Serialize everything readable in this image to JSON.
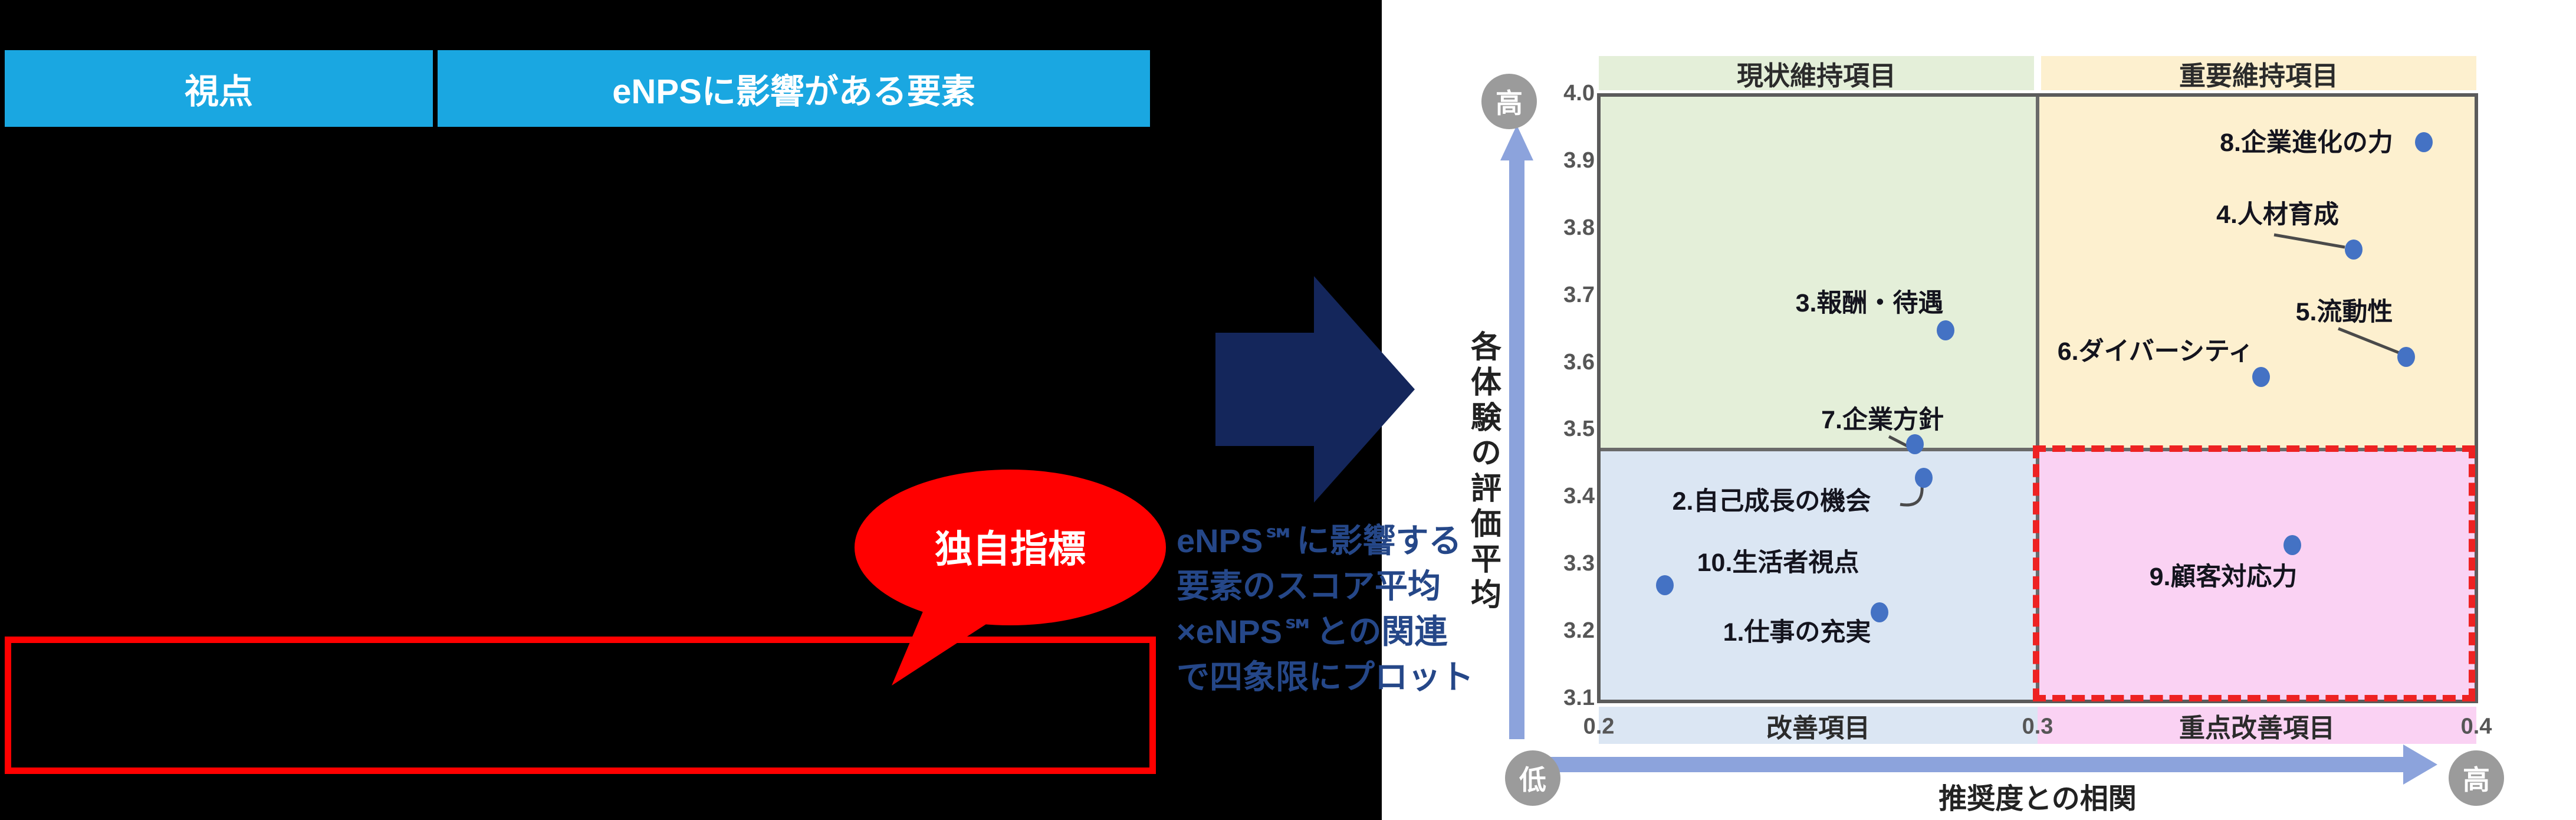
{
  "header_table": {
    "columns": [
      "視点",
      "eNPSに影響がある要素"
    ]
  },
  "callout": {
    "text": "独自指標"
  },
  "annotation": {
    "lines": [
      "eNPS℠に影響する",
      "要素のスコア平均",
      "×eNPS℠との関連",
      "で四象限にプロット"
    ]
  },
  "chart_data": {
    "type": "scatter",
    "xlabel": "推奨度との相関",
    "ylabel": "各体験の評価平均",
    "xlim": [
      0.2,
      0.4
    ],
    "ylim": [
      3.1,
      4.0
    ],
    "x_ticks": [
      "0.2",
      "0.3",
      "0.4"
    ],
    "y_ticks": [
      "4.0",
      "3.9",
      "3.8",
      "3.7",
      "3.6",
      "3.5",
      "3.4",
      "3.3",
      "3.2",
      "3.1"
    ],
    "grid": false,
    "legend": false,
    "quadrant_split": {
      "x": 0.3,
      "y": 3.47
    },
    "quadrant_labels": {
      "top_left": "現状維持項目",
      "top_right": "重要維持項目",
      "bottom_left": "改善項目",
      "bottom_right": "重点改善項目"
    },
    "axis_extremes": {
      "y_high": "高",
      "x_high": "高",
      "low": "低"
    },
    "points": [
      {
        "id": "1",
        "label": "1.仕事の充実",
        "x": 0.264,
        "y": 3.23
      },
      {
        "id": "2",
        "label": "2.自己成長の機会",
        "x": 0.274,
        "y": 3.43
      },
      {
        "id": "3",
        "label": "3.報酬・待遇",
        "x": 0.279,
        "y": 3.65
      },
      {
        "id": "4",
        "label": "4.人材育成",
        "x": 0.372,
        "y": 3.77
      },
      {
        "id": "5",
        "label": "5.流動性",
        "x": 0.384,
        "y": 3.61
      },
      {
        "id": "6",
        "label": "6.ダイバーシティ",
        "x": 0.351,
        "y": 3.58
      },
      {
        "id": "7",
        "label": "7.企業方針",
        "x": 0.272,
        "y": 3.48
      },
      {
        "id": "8",
        "label": "8.企業進化の力",
        "x": 0.388,
        "y": 3.93
      },
      {
        "id": "9",
        "label": "9.顧客対応力",
        "x": 0.358,
        "y": 3.33
      },
      {
        "id": "10",
        "label": "10.生活者視点",
        "x": 0.215,
        "y": 3.27
      }
    ],
    "colors": {
      "quadrant_top_left": "#E4EFD9",
      "quadrant_top_right": "#FDF0CF",
      "quadrant_bottom_left": "#DBE6F3",
      "quadrant_bottom_right": "#FAD2F3",
      "dot": "#4472C4",
      "highlight_border": "#EE2222",
      "axis_arrow": "#8CA3DC",
      "extreme_circle": "#9B9B9B"
    }
  },
  "accent_colors": {
    "header_cyan": "#1AA7E1",
    "arrow_navy": "#14265B",
    "annotation_blue": "#254788",
    "callout_red": "#FF0000"
  }
}
